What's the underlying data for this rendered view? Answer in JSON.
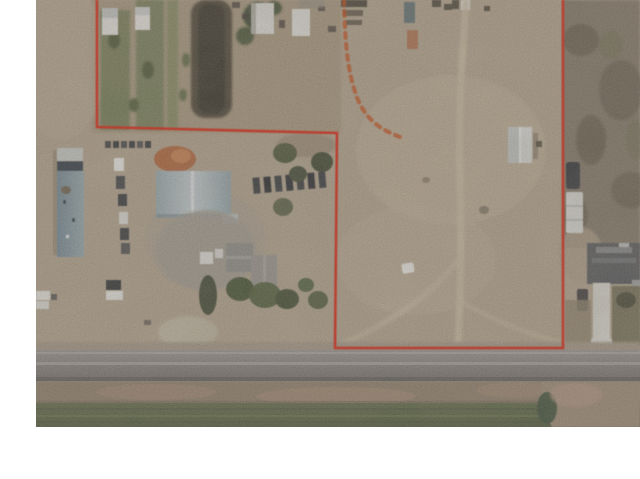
{
  "meta": {
    "type": "aerial-satellite-listing-photo",
    "description": "Satellite aerial photo of a rural property outlined with a red parcel boundary; farm buildings and garden rows at left, open dirt field at right, highway and green crop field along the bottom, white page margins on left and bottom"
  },
  "photo": {
    "frame": {
      "left": 36,
      "top": 0,
      "width": 604,
      "height": 427
    },
    "boundary": {
      "points": "61,0 61,127 301,133 299,348 527,348 527,0",
      "color": "#c23b2c",
      "stroke_width": 2.6
    },
    "trail": {
      "path": "M 308,0 C 309,35 310,70 322,100 C 332,122 346,130 364,137",
      "color": "#b0572f"
    },
    "colors": {
      "page_bg": "#ffffff",
      "dirt_base": "#b1a18b",
      "dirt_light": "#c0b098",
      "dirt_dark": "#8c7c67",
      "road_gray": "#817d7a",
      "field_green": "#57613f",
      "field_dark_green": "#3e5037",
      "brush_dark": "#807465",
      "roof_blue": "#6c8595",
      "roof_steel": "#c2cdd2",
      "roof_gray": "#8a8a87",
      "roof_dark": "#53565a",
      "rust_orange": "#b25e32",
      "white_structure": "#e7e6e2",
      "vehicle_dark": "#2f3339",
      "driveway_white": "#d6d4cd",
      "garden_green": "#6e7850",
      "tilled_dark": "#463f33"
    }
  }
}
